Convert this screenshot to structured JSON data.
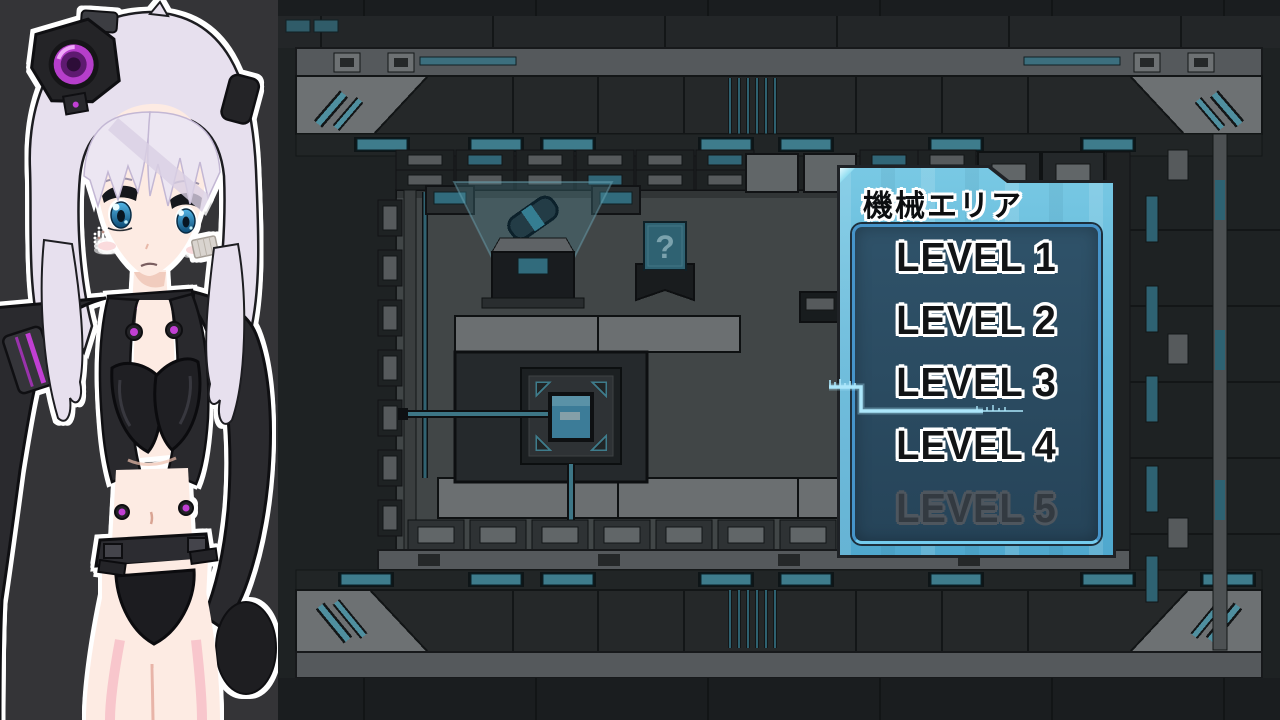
{
  "panel": {
    "title": "機械エリア",
    "selected_level": "LEVEL 3",
    "levels": [
      {
        "label": "LEVEL 1",
        "state": "enabled"
      },
      {
        "label": "LEVEL 2",
        "state": "enabled"
      },
      {
        "label": "LEVEL 3",
        "state": "selected"
      },
      {
        "label": "LEVEL 4",
        "state": "enabled"
      },
      {
        "label": "LEVEL 5",
        "state": "locked"
      }
    ],
    "colors": {
      "panel_blue": "#5cb4d7",
      "panel_blue_light": "#79c9e4",
      "inner_box": "#2b4b61",
      "inner_border": "#4694ca",
      "cursor": "#ace7fb",
      "text": "#121416",
      "text_outline": "#ffffff",
      "locked_text": "#333a41",
      "locked_outline": "#4e565e"
    }
  },
  "map": {
    "question_marker_glyph": "?",
    "colors": {
      "floor": "#54585a",
      "wall_dark": "#2e3133",
      "wall_gray": "#6d7175",
      "corner_gray": "#8d9194",
      "teal_light": "#4f9fb4",
      "outline": "#141618"
    }
  },
  "character": {
    "colors": {
      "background": "#343437",
      "hair": "#e7e0ee",
      "skin": "#fdebe3",
      "outfit_black": "#2a2a2e",
      "accent_magenta": "#c13fd3",
      "eye_blue": "#1c7fb4"
    }
  }
}
